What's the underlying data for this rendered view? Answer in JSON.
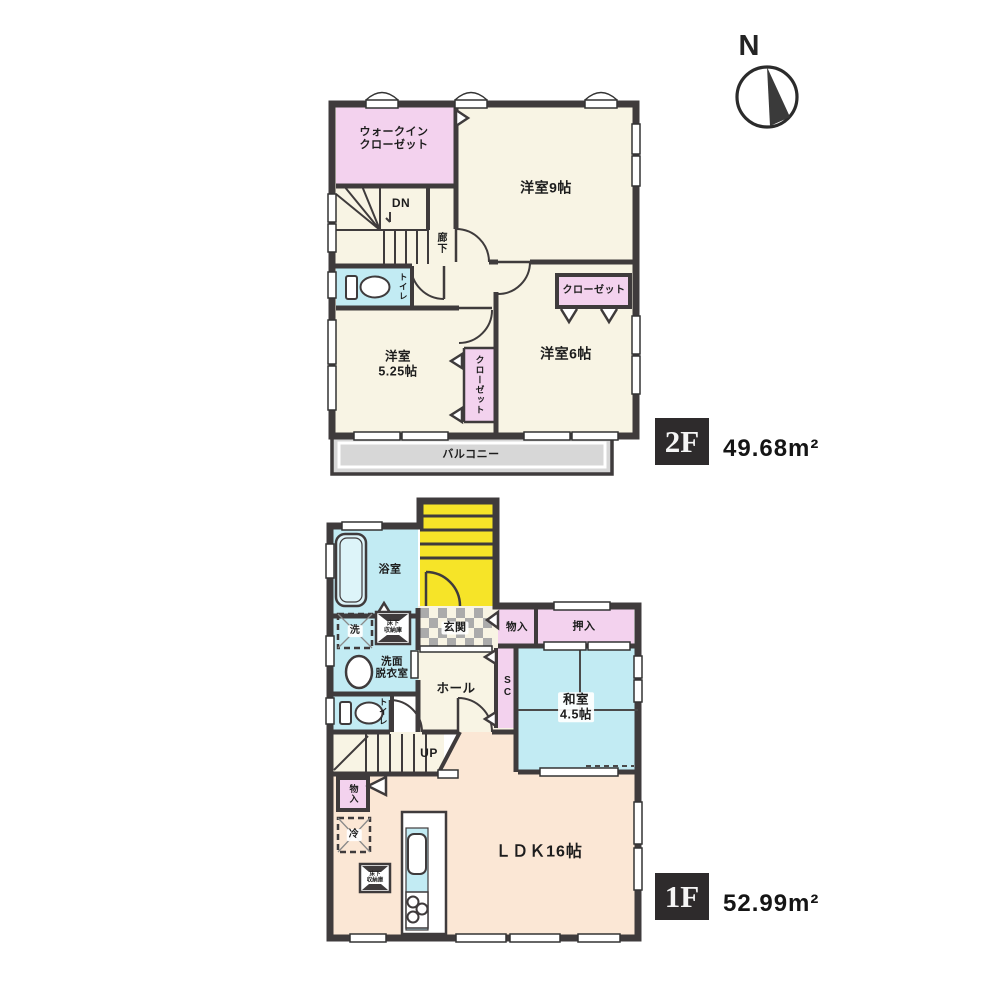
{
  "compass": {
    "label": "N"
  },
  "floor2": {
    "badge": "2F",
    "area": "49.68m²",
    "rooms": {
      "wic": {
        "line1": "ウォークイン",
        "line2": "クローゼット"
      },
      "bedroom9": "洋室9帖",
      "dn": "DN",
      "hallway": "廊下",
      "toilet": "トイレ",
      "bedroom525": {
        "line1": "洋室",
        "line2": "5.25帖"
      },
      "closet_side": "クローゼット",
      "bedroom6": "洋室6帖",
      "closet_back": "クローゼット",
      "balcony": "バルコニー"
    }
  },
  "floor1": {
    "badge": "1F",
    "area": "52.99m²",
    "rooms": {
      "bath": "浴室",
      "laundry": "洗",
      "underfloor1": {
        "line1": "床下",
        "line2": "収納庫"
      },
      "washroom": {
        "line1": "洗面",
        "line2": "脱衣室"
      },
      "entrance": "玄関",
      "storage_entrance": "物入",
      "oshiire": "押入",
      "hall": "ホール",
      "shoe_closet": "SC",
      "washitsu": {
        "line1": "和室",
        "line2": "4.5帖"
      },
      "toilet": "トイレ",
      "up": "UP",
      "storage_ldk": "物入",
      "fridge": "冷",
      "underfloor2": {
        "line1": "床下",
        "line2": "収納庫"
      },
      "ldk": "ＬＤＫ16帖"
    }
  },
  "colors": {
    "wall": "#3f3b3c",
    "cream": "#f8f4e4",
    "pink": "#f3d2ee",
    "cyan": "#c2ebf3",
    "yellow": "#f6e428",
    "peach": "#fbe7d5",
    "balcony_gray": "#d7d7d7"
  }
}
